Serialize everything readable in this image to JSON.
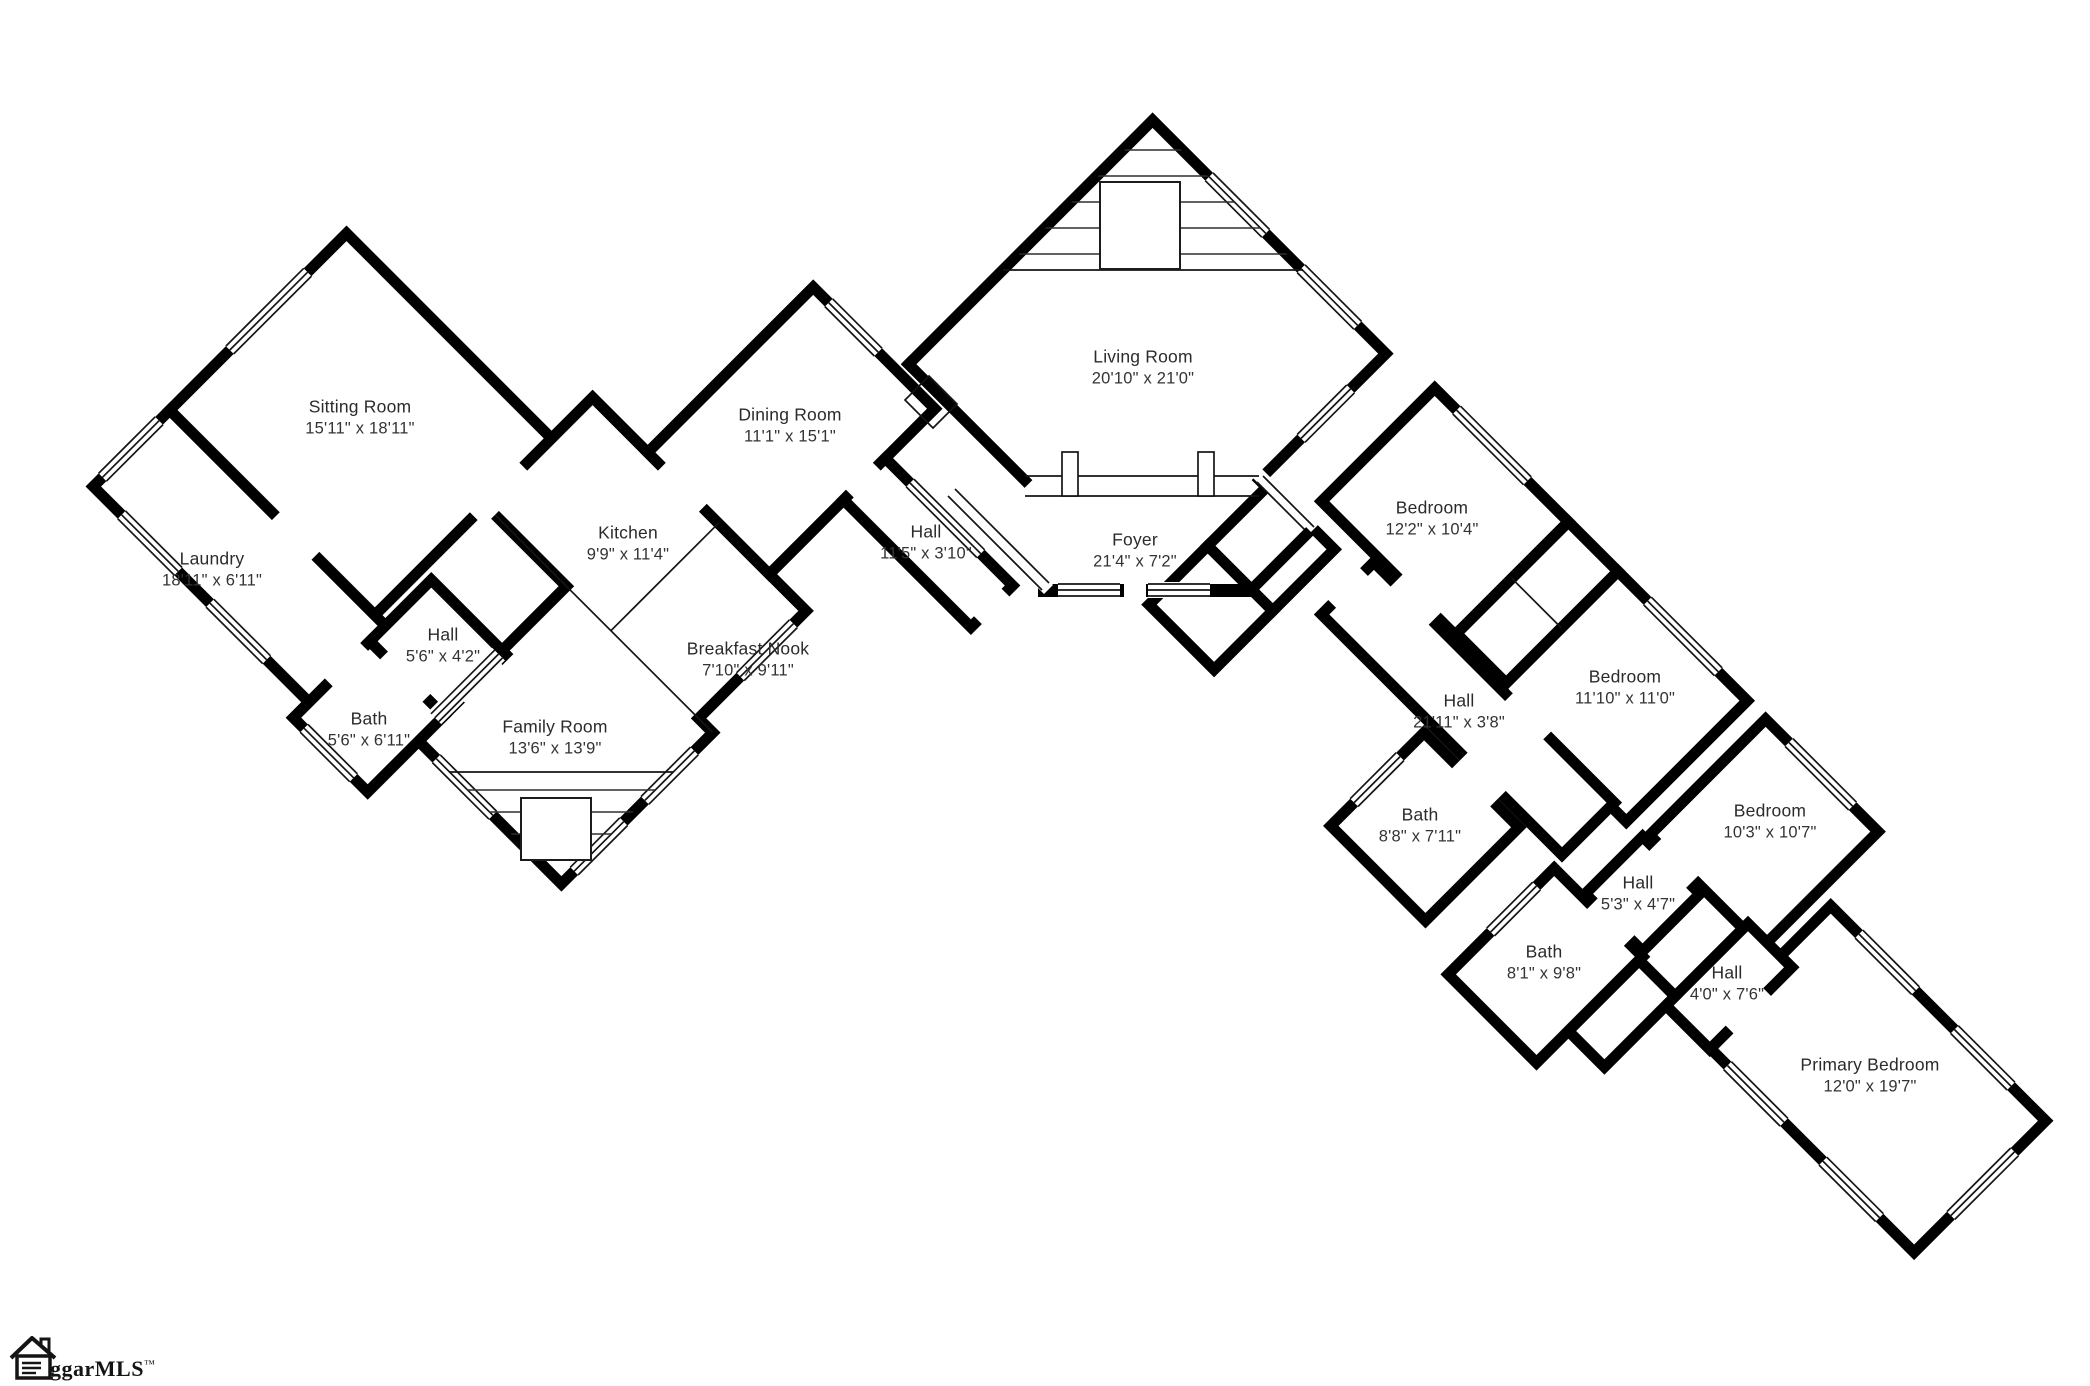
{
  "page": {
    "background": "#ffffff",
    "wall_color": "#000000",
    "text_color": "#2b2b2b"
  },
  "watermark": {
    "text": "ggarMLS",
    "tm": "™"
  },
  "rooms": [
    {
      "id": "sitting",
      "name": "Sitting Room",
      "dims": "15'11\" x 18'11\""
    },
    {
      "id": "laundry",
      "name": "Laundry",
      "dims": "18'11\" x 6'11\""
    },
    {
      "id": "hall-l",
      "name": "Hall",
      "dims": "5'6\" x 4'2\""
    },
    {
      "id": "bath-l",
      "name": "Bath",
      "dims": "5'6\" x 6'11\""
    },
    {
      "id": "kitchen",
      "name": "Kitchen",
      "dims": "9'9\" x 11'4\""
    },
    {
      "id": "dining",
      "name": "Dining Room",
      "dims": "11'1\" x 15'1\""
    },
    {
      "id": "breakfast",
      "name": "Breakfast Nook",
      "dims": "7'10\" x 9'11\""
    },
    {
      "id": "family",
      "name": "Family Room",
      "dims": "13'6\" x 13'9\""
    },
    {
      "id": "hall-115",
      "name": "Hall",
      "dims": "11'5\" x 3'10\""
    },
    {
      "id": "living",
      "name": "Living Room",
      "dims": "20'10\" x 21'0\""
    },
    {
      "id": "foyer",
      "name": "Foyer",
      "dims": "21'4\" x 7'2\""
    },
    {
      "id": "bed1",
      "name": "Bedroom",
      "dims": "12'2\" x 10'4\""
    },
    {
      "id": "bed2",
      "name": "Bedroom",
      "dims": "11'10\" x 11'0\""
    },
    {
      "id": "hall-r",
      "name": "Hall",
      "dims": "21'11\" x 3'8\""
    },
    {
      "id": "bath-88",
      "name": "Bath",
      "dims": "8'8\" x 7'11\""
    },
    {
      "id": "bed3",
      "name": "Bedroom",
      "dims": "10'3\" x 10'7\""
    },
    {
      "id": "hall-53",
      "name": "Hall",
      "dims": "5'3\" x 4'7\""
    },
    {
      "id": "bath-81",
      "name": "Bath",
      "dims": "8'1\" x 9'8\""
    },
    {
      "id": "hall-40",
      "name": "Hall",
      "dims": "4'0\" x 7'6\""
    },
    {
      "id": "primary",
      "name": "Primary Bedroom",
      "dims": "12'0\" x 19'7\""
    }
  ]
}
